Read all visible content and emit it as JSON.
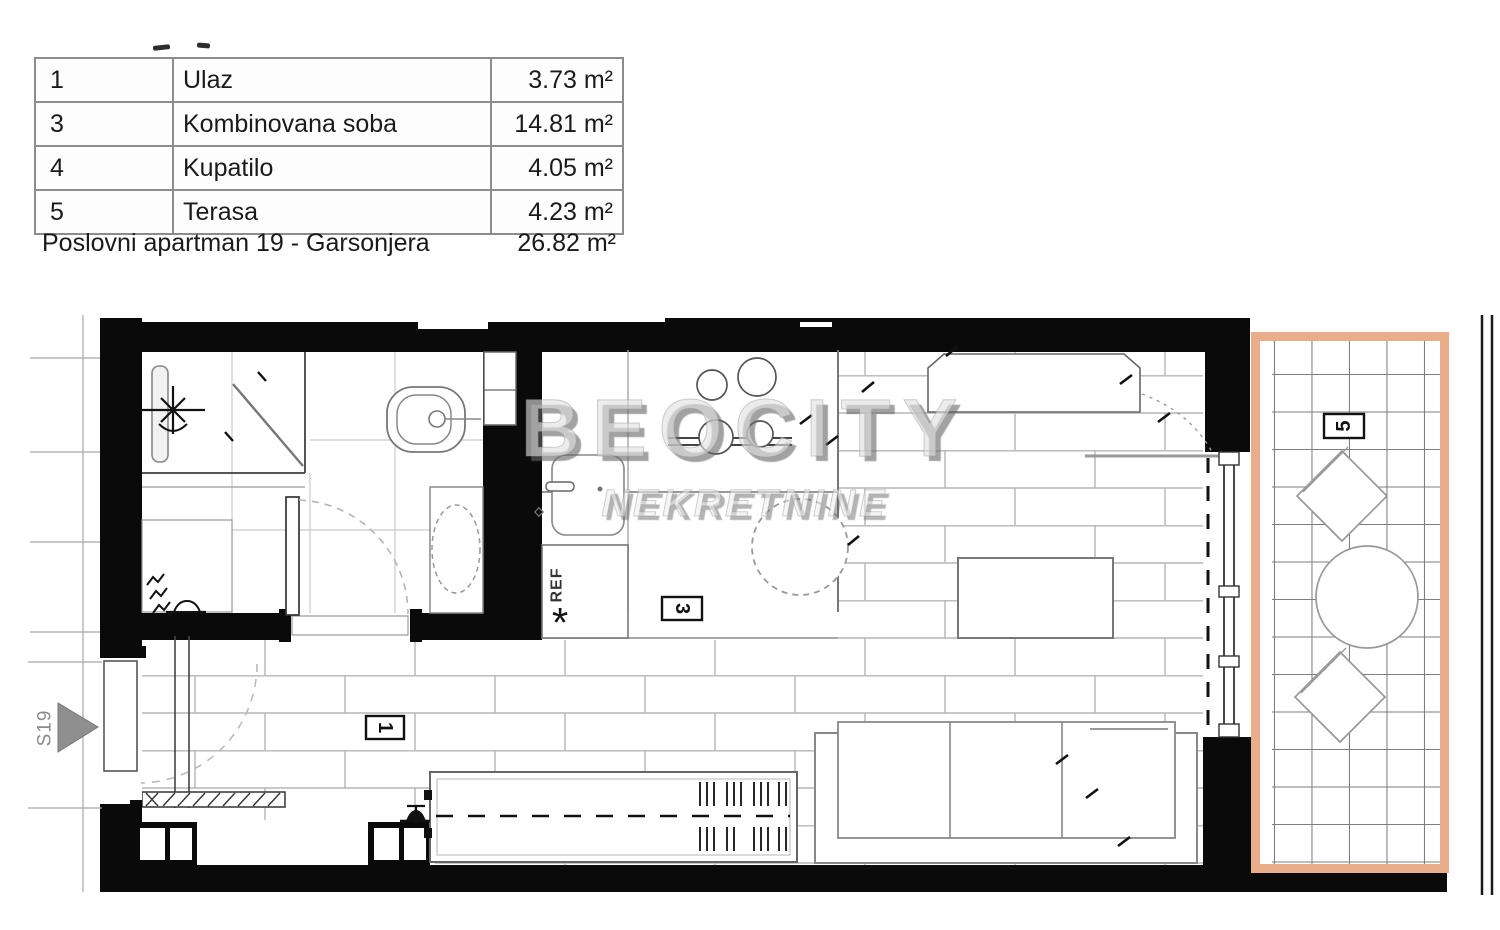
{
  "table": {
    "rows": [
      {
        "num": "1",
        "name": "Ulaz",
        "area": "3.73 m²"
      },
      {
        "num": "3",
        "name": "Kombinovana soba",
        "area": "14.81 m²"
      },
      {
        "num": "4",
        "name": "Kupatilo",
        "area": "4.05 m²"
      },
      {
        "num": "5",
        "name": "Terasa",
        "area": "4.23 m²"
      }
    ],
    "summary_label": "Poslovni apartman 19 - Garsonjera",
    "summary_area": "26.82 m²"
  },
  "watermark": {
    "line1": "BEOCITY",
    "line2": "NEKRETNINE"
  },
  "plan": {
    "labels": {
      "entry": "1",
      "room": "3",
      "bath": "4",
      "terrace": "5"
    },
    "fridge": "REF",
    "boiler_mark": "*",
    "section": "S19",
    "colors": {
      "wall": "#0a0a0a",
      "terrace_border": "#e9ae89",
      "brick_line": "#b2b7b5",
      "tile_line": "#7d7d7d",
      "watermark_gray": "#aaaaaa"
    }
  }
}
